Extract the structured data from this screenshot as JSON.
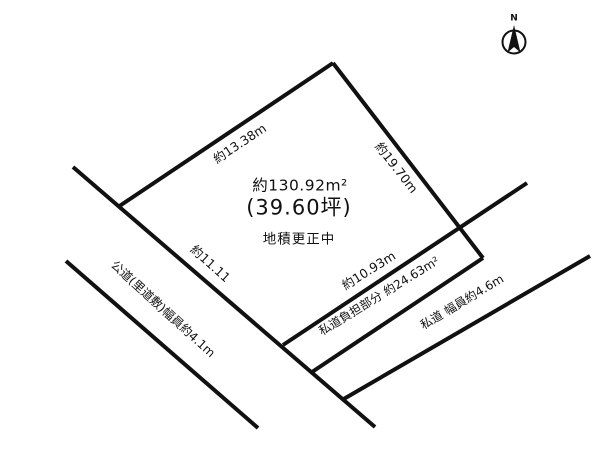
{
  "compass": {
    "north_label": "N"
  },
  "plot": {
    "area_m2": "約130.92m²",
    "area_tsubo": "(39.60坪)",
    "status": "地積更正中",
    "edge_top_left": "約13.38m",
    "edge_right": "約19.70m",
    "edge_bottom_left": "約11.11",
    "edge_bottom": "約10.93m"
  },
  "roads": {
    "public_road": "公道(里道敷)幅員約4.1m",
    "private_road_burden": "私道負担部分 約24.63m²",
    "private_road": "私道 幅員約4.6m"
  },
  "colors": {
    "line": "#111111",
    "background": "#ffffff",
    "text": "#111111"
  }
}
